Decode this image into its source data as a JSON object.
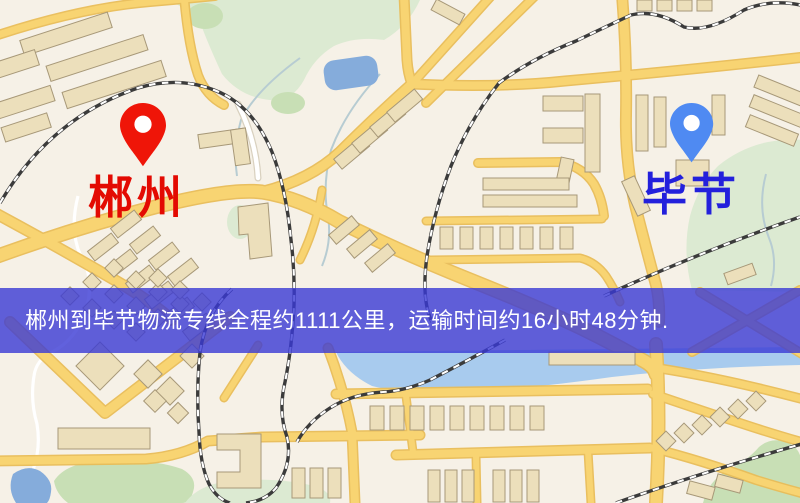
{
  "route_banner": {
    "text": "郴州到毕节物流专线全程约1111公里，运输时间约16小时48分钟.",
    "origin": "郴州",
    "destination": "毕节",
    "distance_text": "约1111公里",
    "duration_text": "约16小时48分钟",
    "bg_color": "rgba(57,57,213,0.80)",
    "text_color": "#ffffff"
  },
  "markers": {
    "origin": {
      "label": "郴州",
      "pin_color": "#ef1508",
      "label_color": "#e30a02"
    },
    "destination": {
      "label": "毕节",
      "pin_color": "#4f8af2",
      "label_color": "#2320dc"
    }
  },
  "map_palette": {
    "background": "#f6f1e7",
    "road_fill": "#f8d472",
    "road_casing": "#e9bd58",
    "building_fill": "#ecdfbb",
    "building_stroke": "#a79878",
    "green_area": "#dcead2",
    "green_dark": "#c8dfb5",
    "water": "#85acdb",
    "water_light": "#a8cbee",
    "railway": "#3b3b3b"
  }
}
